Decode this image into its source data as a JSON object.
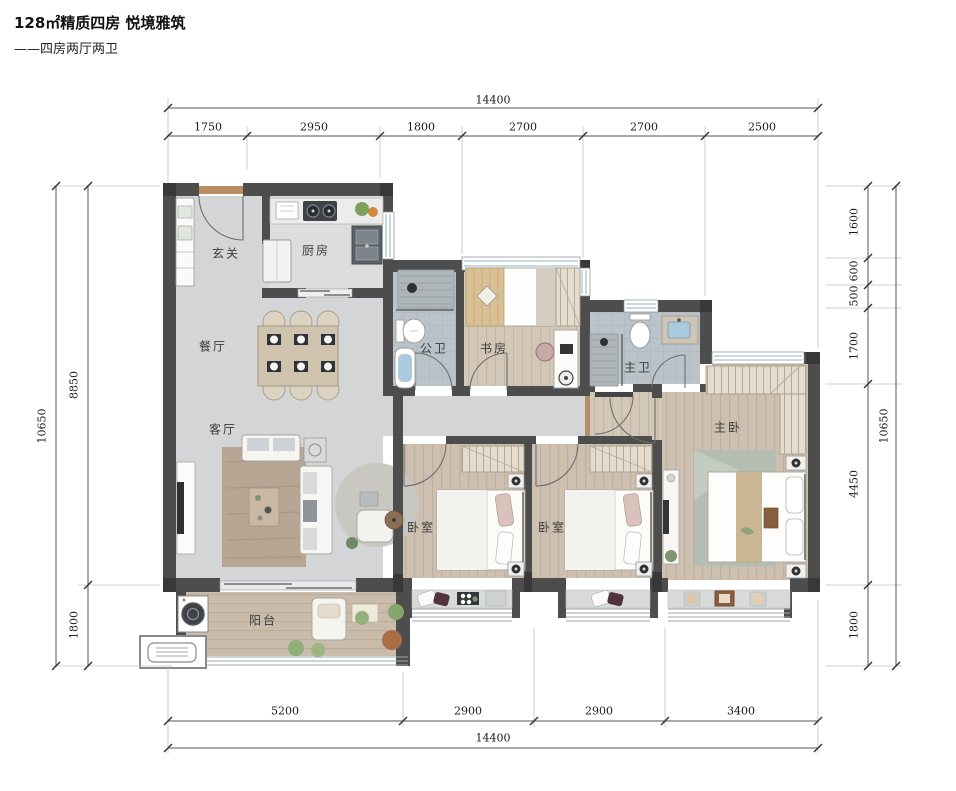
{
  "title": "128㎡精质四房 悦境雅筑",
  "subtitle": "——四房两厅两卫",
  "rooms": {
    "entry": "玄关",
    "kitchen": "厨房",
    "dining": "餐厅",
    "living": "客厅",
    "guest_bath": "公卫",
    "study": "书房",
    "master_bath": "主卫",
    "master_bedroom": "主卧",
    "bedroom_1": "卧室",
    "bedroom_2": "卧室",
    "balcony": "阳台"
  },
  "dimensions": {
    "top": {
      "total": "14400",
      "segments": [
        "1750",
        "2950",
        "1800",
        "2700",
        "2700",
        "2500"
      ]
    },
    "bottom": {
      "total": "14400",
      "segments": [
        "5200",
        "2900",
        "2900",
        "3400"
      ]
    },
    "left": {
      "total": "10650",
      "segments": [
        "8850",
        "1800"
      ]
    },
    "right": {
      "total": "10650",
      "segments": [
        "1600",
        "600",
        "500",
        "1700",
        "4450",
        "1800"
      ]
    }
  },
  "colors": {
    "wall": "#4d4d4d",
    "marble_floor": "#d3d5d6",
    "wood_floor": "#cdc0b1",
    "tile_floor": "#b9c3c9",
    "window_glass": "#8fb6c6",
    "dimension_text": "#1a1a1a"
  }
}
